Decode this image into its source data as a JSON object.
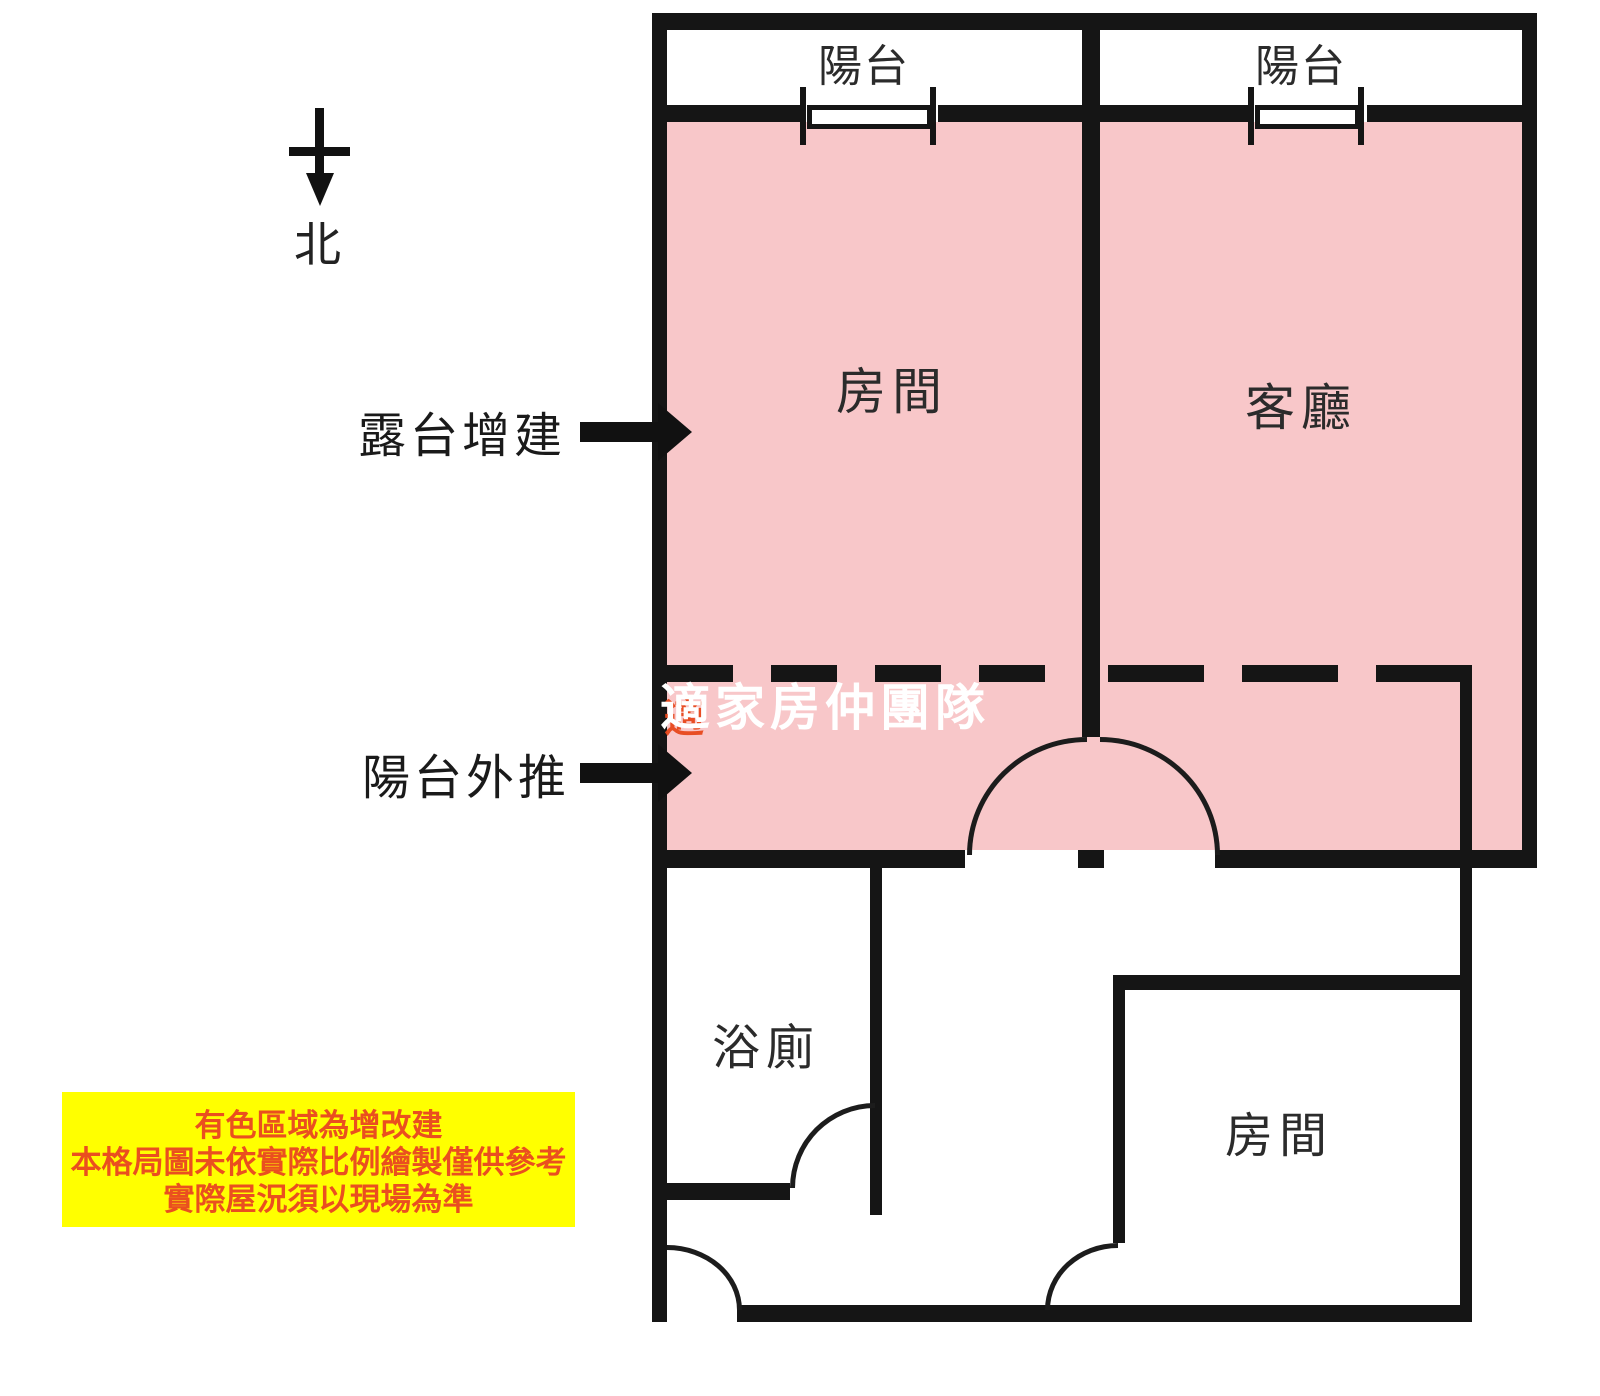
{
  "compass": {
    "label": "北"
  },
  "rooms": {
    "balcony_left": "陽台",
    "balcony_right": "陽台",
    "bedroom_top": "房間",
    "living_room": "客廳",
    "bathroom": "浴廁",
    "bedroom_bottom": "房間"
  },
  "annotations": {
    "terrace_addition": "露台增建",
    "balcony_pushout": "陽台外推"
  },
  "watermark": {
    "text": "適家房仲團隊",
    "fragment": "適"
  },
  "disclaimer": {
    "lines": [
      "有色區域為增改建",
      "本格局圖未依實際比例繪製僅供參考",
      "實際屋況須以現場為準"
    ],
    "background": "#ffff00",
    "text_color": "#ea4f1f"
  },
  "colors": {
    "highlight_pink": "#f8c7c9",
    "wall_black": "#151515",
    "watermark_white": "#ffffff",
    "fragment_orange": "#e8481c"
  },
  "legend_meaning": "有色區域為增改建"
}
